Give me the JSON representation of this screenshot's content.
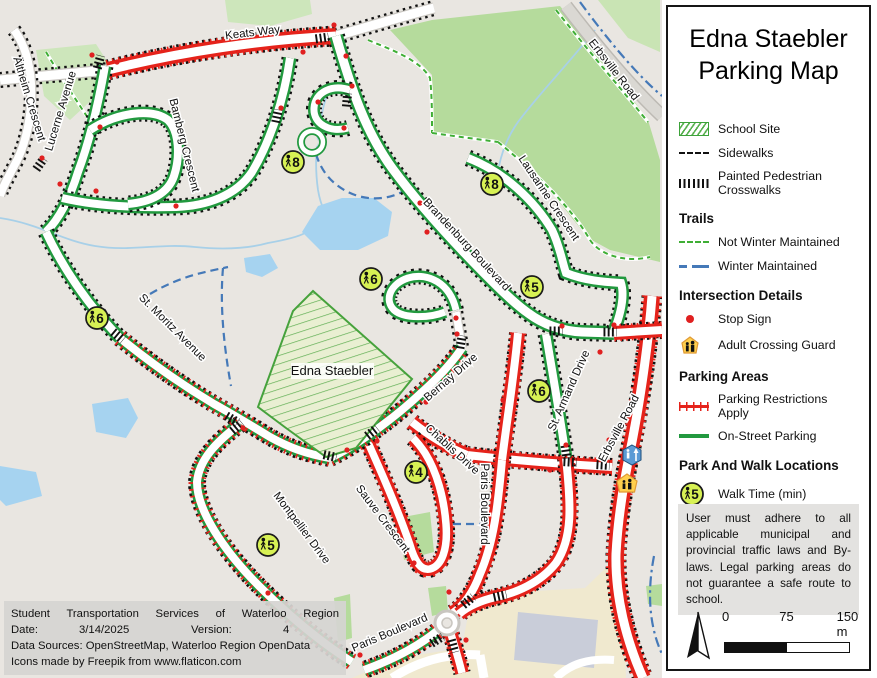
{
  "legend": {
    "title": [
      "Edna Staebler",
      "Parking Map"
    ],
    "base_items": [
      {
        "key": "school",
        "label": "School Site"
      },
      {
        "key": "sidewalk",
        "label": "Sidewalks"
      },
      {
        "key": "crosswalk",
        "label": "Painted Pedestrian Crosswalks"
      }
    ],
    "sections": [
      {
        "heading": "Trails",
        "items": [
          {
            "key": "trail-green",
            "label": "Not Winter Maintained"
          },
          {
            "key": "trail-blue",
            "label": "Winter Maintained"
          }
        ]
      },
      {
        "heading": "Intersection Details",
        "items": [
          {
            "key": "stop",
            "label": "Stop Sign"
          },
          {
            "key": "guard",
            "label": "Adult Crossing Guard"
          }
        ]
      },
      {
        "heading": "Parking Areas",
        "items": [
          {
            "key": "restriction",
            "label": "Parking Restrictions Apply"
          },
          {
            "key": "onstreet",
            "label": "On-Street Parking"
          }
        ]
      },
      {
        "heading": "Park And Walk Locations",
        "items": [
          {
            "key": "walk",
            "label": "Walk Time (min)",
            "badge": "5"
          }
        ]
      }
    ],
    "disclaimer": "User must adhere to all applicable municipal and provincial traffic laws and By-laws. Legal parking areas do not guarantee a safe route to school.",
    "scale": {
      "zero": "0",
      "mid": "75",
      "end": "150 m"
    }
  },
  "info_box": {
    "line1": "Student Transportation Services of Waterloo Region",
    "date_label": "Date:",
    "date_value": "3/14/2025",
    "version_label": "Version:",
    "version_value": "4",
    "line3": "Data Sources: OpenStreetMap, Waterloo Region OpenData",
    "line4": "Icons made by Freepik from www.flaticon.com"
  },
  "map": {
    "school_label": "Edna Staebler",
    "street_labels": [
      {
        "text": "Keats Way",
        "x": 253,
        "y": 36,
        "rot": -7
      },
      {
        "text": "Ältheim Crescent",
        "x": 26,
        "y": 100,
        "rot": 73
      },
      {
        "text": "Lucerne Avenue",
        "x": 64,
        "y": 112,
        "rot": -73
      },
      {
        "text": "Bamberg Crescent",
        "x": 181,
        "y": 146,
        "rot": 76
      },
      {
        "text": "Erbsville Road",
        "x": 611,
        "y": 72,
        "rot": 52
      },
      {
        "text": "Brandenburg Boulevard",
        "x": 464,
        "y": 247,
        "rot": 47
      },
      {
        "text": "Lausanne Crescent",
        "x": 546,
        "y": 200,
        "rot": 56
      },
      {
        "text": "St. Moritz Avenue",
        "x": 170,
        "y": 330,
        "rot": 45
      },
      {
        "text": "Bernay Drive",
        "x": 453,
        "y": 380,
        "rot": -41
      },
      {
        "text": "Chablis Drive",
        "x": 450,
        "y": 452,
        "rot": 42
      },
      {
        "text": "St. Armand Drive",
        "x": 572,
        "y": 392,
        "rot": -66
      },
      {
        "text": "Erbsville Road",
        "x": 622,
        "y": 430,
        "rot": -62
      },
      {
        "text": "Montpellier Drive",
        "x": 299,
        "y": 530,
        "rot": 53
      },
      {
        "text": "Sauve Crescent",
        "x": 380,
        "y": 521,
        "rot": 53
      },
      {
        "text": "Paris Boulevard",
        "x": 481,
        "y": 504,
        "rot": 90
      },
      {
        "text": "Paris Boulevard",
        "x": 391,
        "y": 636,
        "rot": -23
      }
    ],
    "walk_markers": [
      {
        "time": "8",
        "x": 293,
        "y": 162
      },
      {
        "time": "8",
        "x": 492,
        "y": 184
      },
      {
        "time": "6",
        "x": 97,
        "y": 318
      },
      {
        "time": "6",
        "x": 371,
        "y": 279
      },
      {
        "time": "5",
        "x": 532,
        "y": 287
      },
      {
        "time": "6",
        "x": 539,
        "y": 391
      },
      {
        "time": "4",
        "x": 416,
        "y": 472
      },
      {
        "time": "5",
        "x": 268,
        "y": 545
      }
    ],
    "colors": {
      "restriction_red": "#e5231b",
      "parking_green": "#22993f",
      "trail_green": "#3fae35",
      "trail_blue": "#4579b8",
      "marker_fill": "#d7f154",
      "water": "#a6d3f0",
      "park": "#b5db9c"
    }
  }
}
